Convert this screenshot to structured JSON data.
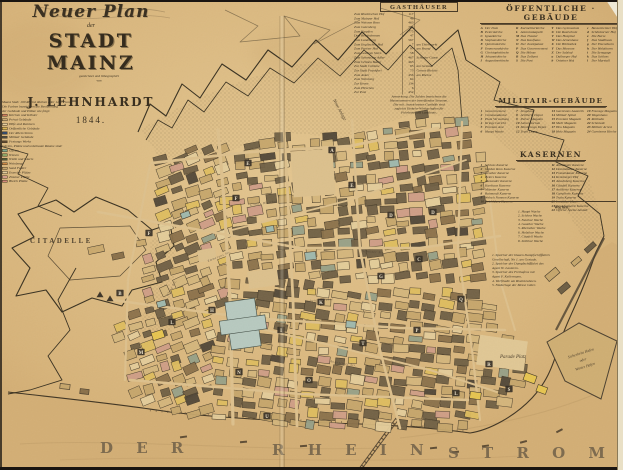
{
  "title": {
    "line1": "Neuer Plan",
    "line2": "der",
    "line3": "STADT MAINZ",
    "line4": "gezeichnet und lithographirt",
    "line5": "von",
    "line6": "J. LEHNHARDT",
    "line7": "1844."
  },
  "key_left": {
    "notes": [
      "Maass Stab: 100 Rheinl. Ruthen oder 1250 Fuss.",
      "Die Farben bezeichnen die Bestimmung",
      "der Gebäude und Plätze wie folgt:"
    ],
    "items": [
      {
        "color": "#cf7c5e",
        "label": "Kirchen und Klöster"
      },
      {
        "color": "#c9ab77",
        "label": "Privat Gebäude"
      },
      {
        "color": "#e4cd9d",
        "label": "Höfe und Remisen"
      },
      {
        "color": "#dcb755",
        "label": "Oeffentliche Gebäude"
      },
      {
        "color": "#32496b",
        "label": "Der Rhein Strom"
      },
      {
        "color": "#4c4a41",
        "label": "Militair Gebäude"
      },
      {
        "color": "#5d4730",
        "label": "Festungs Werke"
      }
    ],
    "mid_note": "Gärten, Plätze und unbebaute Räume sind:",
    "items2": [
      {
        "color": "#7ea78e",
        "label": "Gärten"
      },
      {
        "color": "#8ba466",
        "label": "Wiesen"
      },
      {
        "color": "#4f5b38",
        "label": "Wälle und Glacis"
      },
      {
        "color": "#cd8845",
        "label": "Weinberge"
      },
      {
        "color": "#c7a66d",
        "label": "Sand Felder"
      },
      {
        "color": "#e2cd9c",
        "label": "Exercier Plätze"
      },
      {
        "color": "#d49d8c",
        "label": "Zimmer Plätze"
      },
      {
        "color": "#d2887b",
        "label": "Bleich Plätze"
      }
    ]
  },
  "gasthaeuser": {
    "header": "GASTHÄUSER",
    "items": [
      {
        "name": "Zum Rheinischen Hof",
        "num": "117",
        "note": ""
      },
      {
        "name": "Zum Mainzer Hof",
        "num": "48",
        "note": ""
      },
      {
        "name": "Zum Weissen Ross",
        "num": "463",
        "note": ""
      },
      {
        "name": "Zum Gutenberg",
        "num": "704",
        "note": ""
      },
      {
        "name": "Zum Karpfen",
        "num": "775",
        "note": ""
      },
      {
        "name": "Drei Reichskronen",
        "num": "47",
        "note": ""
      },
      {
        "name": "Zum Landsberg",
        "num": "567",
        "note": ""
      },
      {
        "name": "Zum Englischen Hof",
        "num": "7",
        "note": "am Thiermarkt"
      },
      {
        "name": "Zum Pariser Hof",
        "num": "97",
        "note": "am Brand"
      },
      {
        "name": "Zum Goldnen Stern",
        "num": "58",
        "note": ""
      },
      {
        "name": "Zum Schwarzen Adler",
        "num": "467",
        "note": "Schuster Gasse"
      },
      {
        "name": "Zum Grünen Baum",
        "num": "463",
        "note": ""
      },
      {
        "name": "Zur Stadt Coblenz",
        "num": "85",
        "note": "am Gestade"
      },
      {
        "name": "Zur Stadt Frankfurt",
        "num": "73",
        "note": "Grosse Bleiche"
      },
      {
        "name": "Zum Anker",
        "num": "456",
        "note": "am Rheine"
      },
      {
        "name": "Zum Weinberg",
        "num": "64",
        "note": ""
      },
      {
        "name": "Zur Krone",
        "num": "134",
        "note": ""
      },
      {
        "name": "Zum Hirschen",
        "num": "6",
        "note": ""
      },
      {
        "name": "Zur Post",
        "num": "452",
        "note": ""
      }
    ],
    "footnotes": [
      "Anmerkung. Die Zahlen bezeichnen die",
      "Hausnummern der betreffenden Strassen.",
      "Die mit . bezeichneten Gasthöfe sind",
      "zugleich Einkehr-Wirthschaften für",
      "Fuhrleute und Landleute."
    ]
  },
  "oeffentliche": {
    "header": "ÖFFENTLICHE · GEBÄUDE",
    "columns": [
      [
        {
          "k": "A",
          "t": "Der Dom"
        },
        {
          "k": "B",
          "t": "Peterskirche"
        },
        {
          "k": "C",
          "t": "Ignazkirche"
        },
        {
          "k": "D",
          "t": "Stephanskirche"
        },
        {
          "k": "E",
          "t": "Quintinskirche"
        },
        {
          "k": "F",
          "t": "Emmeranskirche"
        },
        {
          "k": "G",
          "t": "Christophskirche"
        },
        {
          "k": "H",
          "t": "Johanniskirche"
        },
        {
          "k": "I",
          "t": "Augustinerkirche"
        }
      ],
      [
        {
          "k": "K",
          "t": "Karmeliterkirche"
        },
        {
          "k": "L",
          "t": "Antoniuskapelle"
        },
        {
          "k": "M",
          "t": "Das Theater"
        },
        {
          "k": "N",
          "t": "Das Kaufhaus"
        },
        {
          "k": "O",
          "t": "Der Justizpalast"
        },
        {
          "k": "P",
          "t": "Das Gouvernement"
        },
        {
          "k": "Q",
          "t": "Die Münze"
        },
        {
          "k": "R",
          "t": "Das Zollamt"
        },
        {
          "k": "S",
          "t": "Die Post"
        }
      ],
      [
        {
          "k": "T",
          "t": "Das Gymnasium"
        },
        {
          "k": "U",
          "t": "Die Realschule"
        },
        {
          "k": "V",
          "t": "Das Hospital"
        },
        {
          "k": "W",
          "t": "Das Armenhaus"
        },
        {
          "k": "X",
          "t": "Die Bibliothek"
        },
        {
          "k": "Y",
          "t": "Das Museum"
        },
        {
          "k": "Z",
          "t": "Der Salzhof"
        },
        {
          "k": "a",
          "t": "Dalberger Hof"
        },
        {
          "k": "b",
          "t": "Osteiner Hof"
        }
      ],
      [
        {
          "k": "c",
          "t": "Bassenheimer Hof"
        },
        {
          "k": "d",
          "t": "Schönborner Hof"
        },
        {
          "k": "e",
          "t": "Die Burse"
        },
        {
          "k": "f",
          "t": "Das Stadthaus"
        },
        {
          "k": "g",
          "t": "Der Eisenthurm"
        },
        {
          "k": "h",
          "t": "Der Holzthurm"
        },
        {
          "k": "i",
          "t": "Die Synagoge"
        },
        {
          "k": "k",
          "t": "Das Schloss"
        },
        {
          "k": "l",
          "t": "Der Marstall"
        }
      ]
    ]
  },
  "militair": {
    "header": "MILITAIR-GEBÄUDE",
    "columns": [
      [
        {
          "k": "1",
          "t": "Gouvernement"
        },
        {
          "k": "2",
          "t": "Commandantur"
        },
        {
          "k": "3",
          "t": "Platz Verwaltung"
        },
        {
          "k": "4",
          "t": "Kriegs Gericht"
        },
        {
          "k": "5",
          "t": "Proviant Amt"
        },
        {
          "k": "6",
          "t": "Haupt Wache"
        }
      ],
      [
        {
          "k": "7",
          "t": "Zeughaus"
        },
        {
          "k": "8",
          "t": "Artillerie Depot"
        },
        {
          "k": "9",
          "t": "Pulver Magazin"
        },
        {
          "k": "10",
          "t": "Laboratorium"
        },
        {
          "k": "11",
          "t": "Montirungs Depot"
        },
        {
          "k": "12",
          "t": "Train Depot"
        }
      ],
      [
        {
          "k": "13",
          "t": "Garnisons Lazareth"
        },
        {
          "k": "14",
          "t": "Militair Spital"
        },
        {
          "k": "15",
          "t": "Proviant Magazin"
        },
        {
          "k": "16",
          "t": "Mehl Magazin"
        },
        {
          "k": "17",
          "t": "Heu Magazin"
        },
        {
          "k": "18",
          "t": "Holz Magazin"
        }
      ],
      [
        {
          "k": "19",
          "t": "Fourage Magazin"
        },
        {
          "k": "20",
          "t": "Wagenhaus"
        },
        {
          "k": "21",
          "t": "Reitbahn"
        },
        {
          "k": "22",
          "t": "Schmiede"
        },
        {
          "k": "23",
          "t": "Militair Arrest"
        },
        {
          "k": "24",
          "t": "Garnisons Kirche"
        }
      ]
    ]
  },
  "kasernen": {
    "header": "KASERNEN",
    "columns": [
      [
        {
          "k": "1",
          "t": "Schloss Kaserne"
        },
        {
          "k": "2",
          "t": "Golden Ross Kaserne"
        },
        {
          "k": "3",
          "t": "Neuthor Kaserne"
        },
        {
          "k": "4",
          "t": "Peters Kaserne"
        },
        {
          "k": "5",
          "t": "Alexander Kaserne"
        },
        {
          "k": "6",
          "t": "Karthaus Kaserne"
        },
        {
          "k": "7",
          "t": "Münster Kaserne"
        },
        {
          "k": "8",
          "t": "Raimundi Kaserne"
        },
        {
          "k": "9",
          "t": "Welsch Nonnen Kaserne"
        },
        {
          "k": "10",
          "t": "Reichklara Kaserne"
        }
      ],
      [
        {
          "k": "11",
          "t": "Altmünster Kaserne"
        },
        {
          "k": "12",
          "t": "Dominikaner Kaserne"
        },
        {
          "k": "13",
          "t": "Franziskaner Kaserne"
        },
        {
          "k": "14",
          "t": "Kronberger Hof"
        },
        {
          "k": "15",
          "t": "Jakobsberg Kaserne"
        },
        {
          "k": "16",
          "t": "Citadell Kaserne"
        },
        {
          "k": "17",
          "t": "Artillerie Kaserne"
        },
        {
          "k": "18",
          "t": "Cavallerie Kaserne"
        },
        {
          "k": "19",
          "t": "Train Kaserne"
        },
        {
          "k": "20",
          "t": "Invaliden Haus"
        },
        {
          "k": "21",
          "t": "Gensdarmerie Kaserne"
        },
        {
          "k": "22",
          "t": "Officier Speise Anstalt"
        }
      ]
    ],
    "wachen_header": "Wachen:",
    "wachen": [
      {
        "k": "1",
        "t": "Haupt Wache"
      },
      {
        "k": "2",
        "t": "Schloss Wache"
      },
      {
        "k": "3",
        "t": "Neuthor Wache"
      },
      {
        "k": "4",
        "t": "Gauthor Wache"
      },
      {
        "k": "5",
        "t": "Rheinthor Wache"
      },
      {
        "k": "6",
        "t": "Holzthor Wache"
      },
      {
        "k": "7",
        "t": "Citadell Wache"
      },
      {
        "k": "8",
        "t": "Zollthor Wache"
      }
    ],
    "speicher": [
      "1. Speicher der blauen Dampfschifffahrts",
      "    Gesellschaft, No 1. am Gestade.",
      "2. Speicher der Dampfschifffahrt des",
      "    Agent W. Lauteren.",
      "3. Speicher des Freihafens mit",
      "    Agent F. Kellermann.",
      "4. Werfthalle am Rheinkrahnen.",
      "5. Niederlage der Messe Güter."
    ]
  },
  "map": {
    "citadelle": "CITADELLE",
    "river_word1": "D E R",
    "river_word2": "R H E I N",
    "river_word3": "S T R O M",
    "neue_anlage": "Neue Anlage",
    "parade_platz": "Parade Platz",
    "harbor_line1": "Sicherheits Hafen",
    "harbor_line2": "oder",
    "harbor_line3": "Winter Hafen",
    "street_labels": [
      {
        "t": "Grosse Bleiche",
        "x": 250,
        "y": 206,
        "r": -8
      },
      {
        "t": "Ludwigs Strasse",
        "x": 305,
        "y": 302,
        "r": -4
      },
      {
        "t": "Augustiner Str.",
        "x": 330,
        "y": 362,
        "r": 10
      },
      {
        "t": "Emmerans Str.",
        "x": 208,
        "y": 262,
        "r": -22
      },
      {
        "t": "Schuster Str.",
        "x": 362,
        "y": 252,
        "r": 4
      },
      {
        "t": "Klara Str.",
        "x": 168,
        "y": 296,
        "r": -60
      }
    ],
    "block_letters": [
      {
        "ch": "A",
        "x": 332,
        "y": 150
      },
      {
        "ch": "E",
        "x": 248,
        "y": 163
      },
      {
        "ch": "E",
        "x": 352,
        "y": 185
      },
      {
        "ch": "F",
        "x": 236,
        "y": 198
      },
      {
        "ch": "F",
        "x": 149,
        "y": 233
      },
      {
        "ch": "B",
        "x": 120,
        "y": 293
      },
      {
        "ch": "G",
        "x": 381,
        "y": 276
      },
      {
        "ch": "H",
        "x": 212,
        "y": 310
      },
      {
        "ch": "I",
        "x": 281,
        "y": 330
      },
      {
        "ch": "K",
        "x": 321,
        "y": 302
      },
      {
        "ch": "L",
        "x": 172,
        "y": 322
      },
      {
        "ch": "L",
        "x": 456,
        "y": 393
      },
      {
        "ch": "M",
        "x": 141,
        "y": 352
      },
      {
        "ch": "N",
        "x": 239,
        "y": 372
      },
      {
        "ch": "O",
        "x": 309,
        "y": 380
      },
      {
        "ch": "P",
        "x": 417,
        "y": 330
      },
      {
        "ch": "Q",
        "x": 461,
        "y": 299
      },
      {
        "ch": "C",
        "x": 419,
        "y": 259
      },
      {
        "ch": "D",
        "x": 391,
        "y": 215
      },
      {
        "ch": "D",
        "x": 433,
        "y": 212
      },
      {
        "ch": "R",
        "x": 489,
        "y": 364
      },
      {
        "ch": "S",
        "x": 509,
        "y": 389
      },
      {
        "ch": "T",
        "x": 363,
        "y": 343
      },
      {
        "ch": "U",
        "x": 267,
        "y": 416
      }
    ]
  }
}
